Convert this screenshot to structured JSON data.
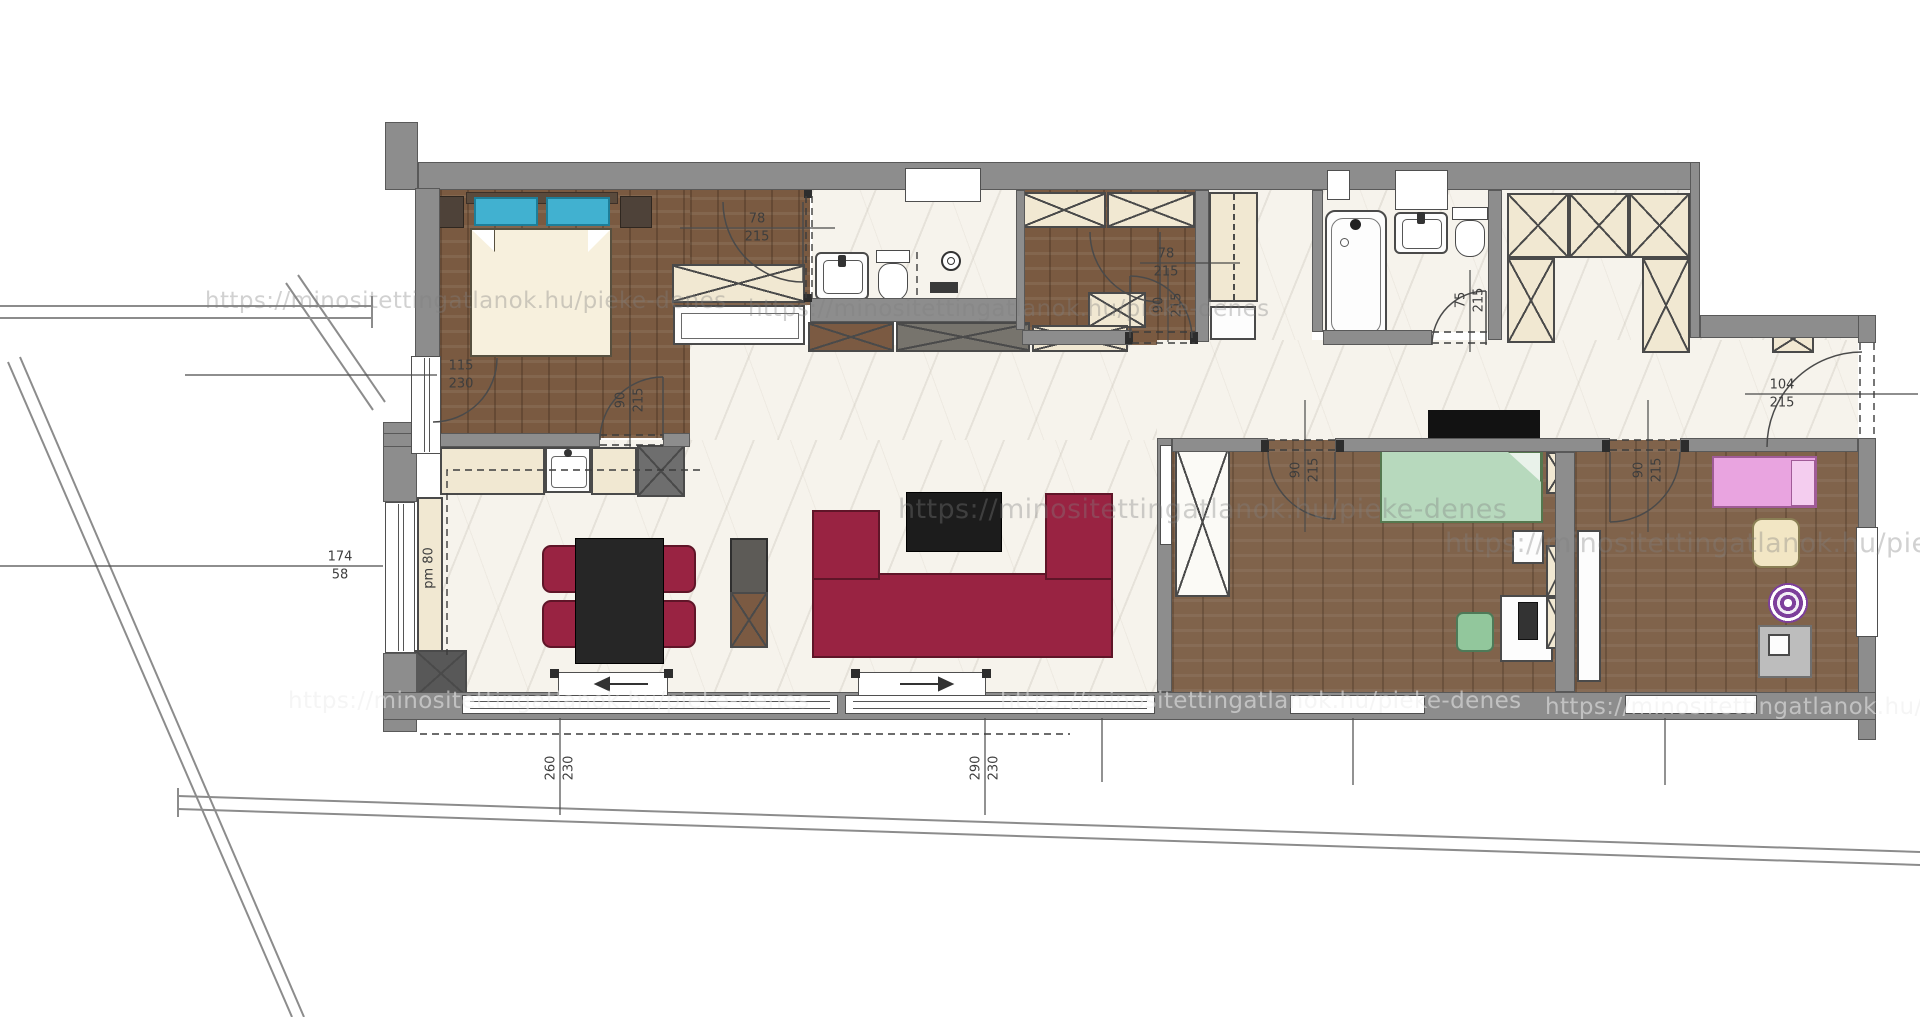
{
  "watermark": {
    "text": "https://minositettingatlanok.hu/pieke-denes"
  },
  "dims": {
    "bedroom_window_w": "115",
    "bedroom_window_h": "230",
    "bedroom_door_w": "90",
    "bedroom_door_h": "215",
    "dressing_door_w": "78",
    "dressing_door_h": "215",
    "closet_door_w": "78",
    "closet_door_h": "215",
    "closet_door2_w": "90",
    "closet_door2_h": "215",
    "bath2_door_w": "75",
    "bath2_door_h": "215",
    "entry_door_w": "104",
    "entry_door_h": "215",
    "left_window_w": "174",
    "left_window_h": "58",
    "parapet_note": "pm 80",
    "terrace1_w": "260",
    "terrace1_h": "230",
    "terrace2_w": "290",
    "terrace2_h": "230",
    "kid1_door_w": "90",
    "kid1_door_h": "215",
    "kid2_door_w": "90",
    "kid2_door_h": "215"
  }
}
